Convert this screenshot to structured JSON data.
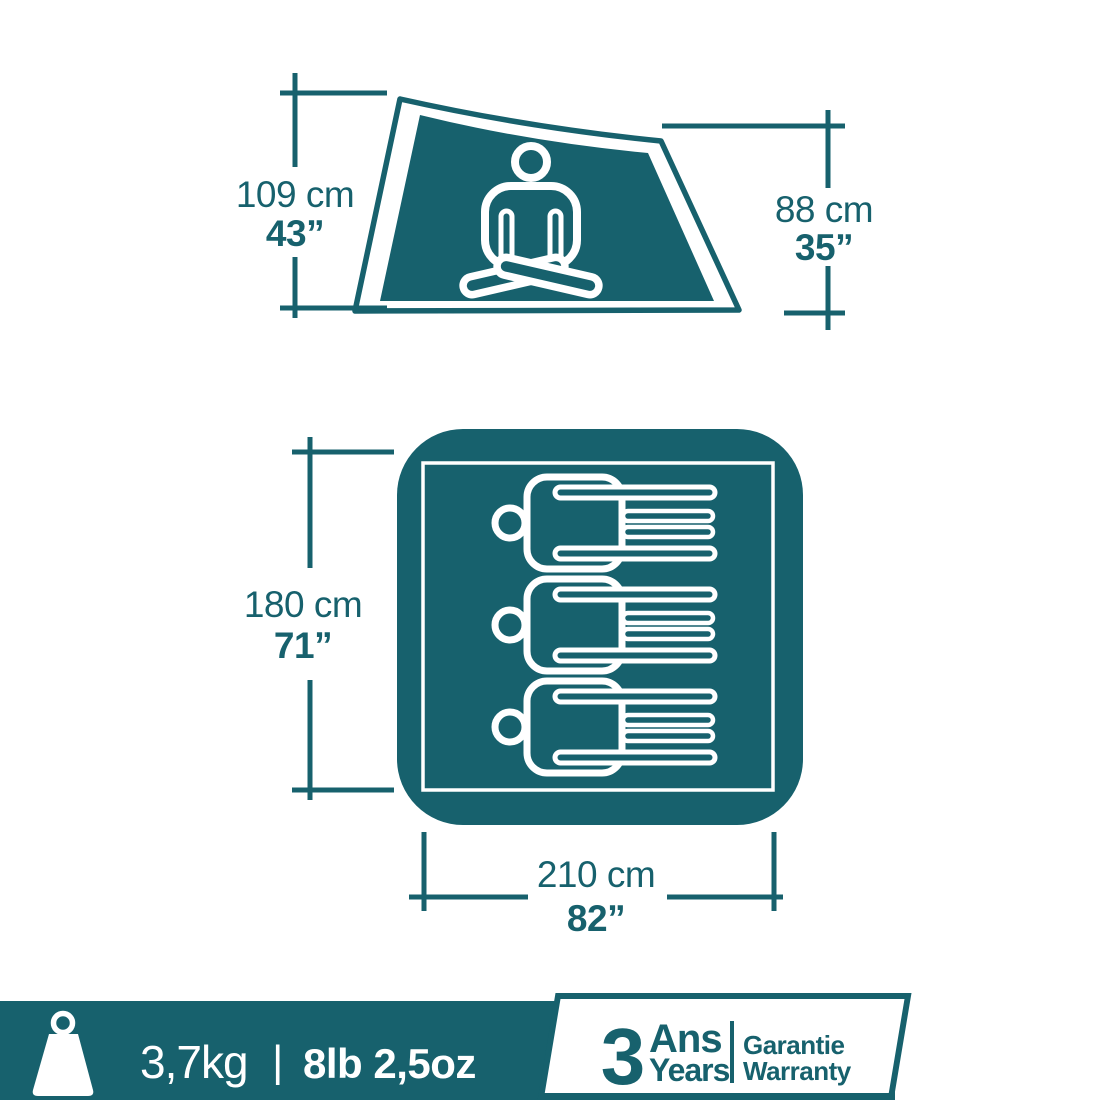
{
  "colors": {
    "teal": "#17616d",
    "white": "#ffffff"
  },
  "top_view": {
    "left_dim": {
      "cm": "109 cm",
      "inch": "43”"
    },
    "right_dim": {
      "cm": "88 cm",
      "inch": "35”"
    }
  },
  "floor_view": {
    "left_dim": {
      "cm": "180 cm",
      "inch": "71”"
    },
    "bottom_dim": {
      "cm": "210 cm",
      "inch": "82”"
    },
    "sleeping_capacity": 3
  },
  "footer": {
    "weight_metric": "3,7kg",
    "divider": "|",
    "weight_imperial": "8lb 2,5oz",
    "warranty_years": "3",
    "warranty_fr": "Ans",
    "warranty_en": "Years",
    "guarantee_fr": "Garantie",
    "guarantee_en": "Warranty"
  }
}
